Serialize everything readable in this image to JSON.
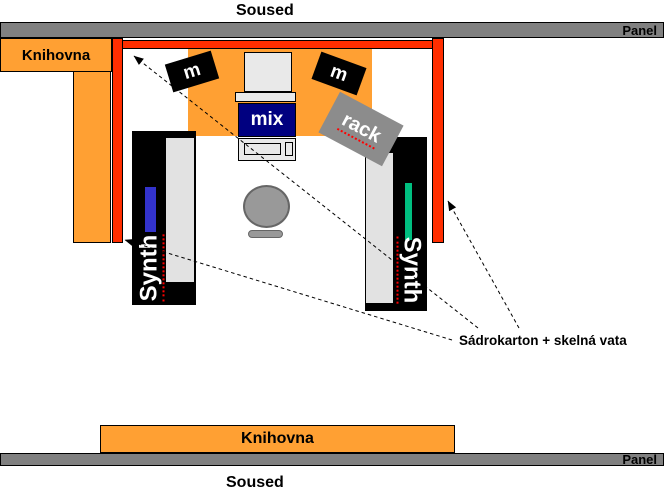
{
  "colors": {
    "orange": "#FFA033",
    "red": "#FF2E00",
    "barGray": "#808080",
    "rackGray": "#8C8C8C",
    "chairGray": "#999999",
    "standBlack": "#000000",
    "lightGray": "#E9E9E9",
    "innerGray": "#E2E2E2",
    "mixerNavy": "#000080",
    "stripeBlue": "#3333CC",
    "stripeGreen": "#00BF80",
    "spellRed": "#FF0000"
  },
  "walls": {
    "neighbor_top": "Soused",
    "neighbor_bottom": "Soused",
    "panel_top": "Panel",
    "panel_bottom": "Panel"
  },
  "furniture": {
    "bookshelf_left": "Knihovna",
    "bookshelf_bottom": "Knihovna"
  },
  "equipment": {
    "speaker_left": "m",
    "speaker_right": "m",
    "mixer": "mix",
    "rack": "rack",
    "synth_left": "Synth",
    "synth_right": "Synth"
  },
  "annotation": {
    "wall_material": "Sádrokarton + skelná vata"
  }
}
